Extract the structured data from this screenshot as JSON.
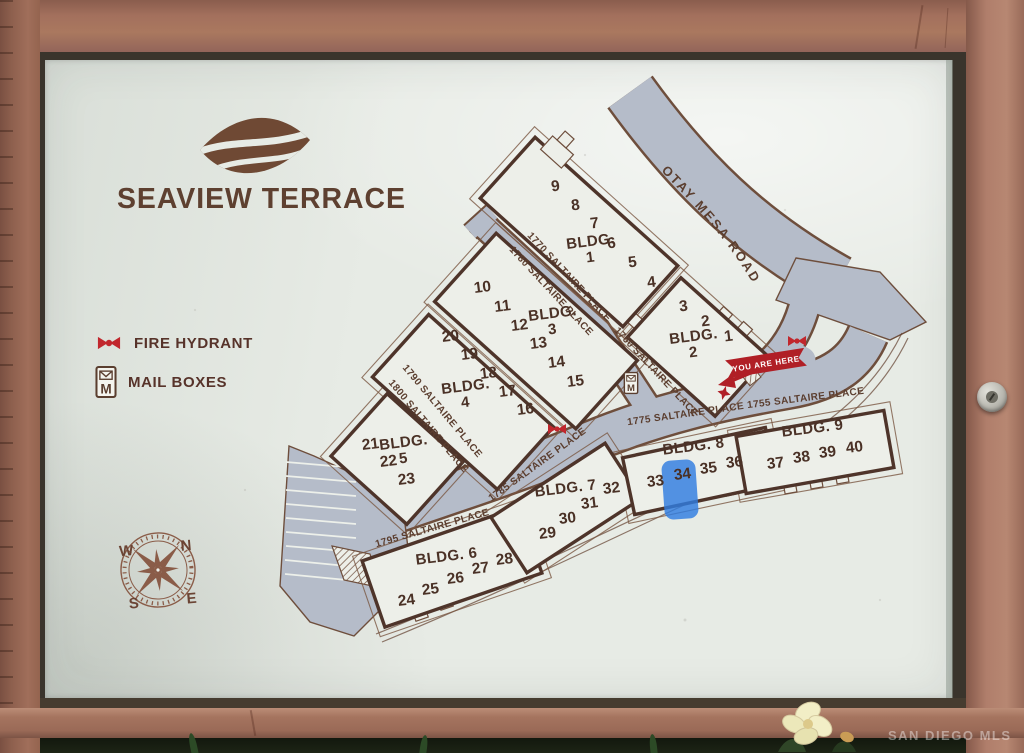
{
  "photo": {
    "watermark": "SAN DIEGO MLS"
  },
  "sign": {
    "title": "SEAVIEW TERRACE",
    "legend": {
      "fire_hydrant": "FIRE HYDRANT",
      "mail_boxes": "MAIL BOXES"
    },
    "compass": {
      "west": "W",
      "north": "N",
      "south": "S",
      "east": "E"
    }
  },
  "map": {
    "streets": {
      "otay": "OTAY MESA ROAD",
      "sp1770": "1770 SALTAIRE PLACE",
      "sp1780": "1780 SALTAIRE PLACE",
      "sp1760": "1760 SALTAIRE PLACE",
      "sp1790": "1790 SALTAIRE PLACE",
      "sp1800": "1800 SALTAIRE PLACE",
      "sp1775": "1775 SALTAIRE PLACE",
      "sp1755": "1755 SALTAIRE PLACE",
      "sp1785": "1785 SALTAIRE PLACE",
      "sp1795": "1795 SALTAIRE PLACE"
    },
    "you_are_here": "YOU ARE HERE",
    "highlight": {
      "unit": "34",
      "color": "#2f7ce0",
      "rect": [
        663,
        460,
        34,
        59,
        9,
        -4
      ]
    },
    "buildings": [
      {
        "name": "bldg-1",
        "label": "BLDG.",
        "num": "1",
        "stacked": true,
        "lx": 591,
        "ly": 246,
        "rect": [
          579,
          232,
          192,
          82,
          42
        ],
        "units": [
          [
            "9",
            556,
            191
          ],
          [
            "8",
            576,
            210
          ],
          [
            "7",
            595,
            228
          ],
          [
            "6",
            612,
            248
          ],
          [
            "5",
            633,
            267
          ],
          [
            "4",
            652,
            287
          ]
        ],
        "porches": [
          [
            589,
            226,
            13
          ],
          [
            607,
            247,
            13
          ],
          [
            625,
            269,
            13
          ],
          [
            643,
            291,
            13
          ],
          [
            634,
            320,
            12
          ],
          [
            654,
            334,
            12
          ]
        ]
      },
      {
        "name": "bldg-2",
        "label": "BLDG.",
        "num": "2",
        "stacked": true,
        "lx": 694,
        "ly": 341,
        "rect": [
          698,
          347,
          118,
          80,
          42
        ],
        "units": [
          [
            "3",
            684,
            311
          ],
          [
            "2",
            706,
            326
          ],
          [
            "1",
            729,
            341
          ]
        ],
        "porches": [
          [
            724,
            315,
            12
          ],
          [
            744,
            330,
            12
          ]
        ]
      },
      {
        "name": "bldg-3",
        "label": "BLDG.",
        "num": "3",
        "stacked": true,
        "lx": 553,
        "ly": 318,
        "rect": [
          536,
          331,
          190,
          92,
          42
        ],
        "units": [
          [
            "10",
            483,
            292
          ],
          [
            "11",
            503,
            311
          ],
          [
            "12",
            520,
            330
          ],
          [
            "13",
            539,
            348
          ],
          [
            "14",
            557,
            367
          ],
          [
            "15",
            576,
            386
          ]
        ],
        "porches": [
          [
            470,
            308,
            15
          ],
          [
            490,
            330,
            15
          ],
          [
            512,
            352,
            15
          ],
          [
            532,
            373,
            15
          ]
        ]
      },
      {
        "name": "bldg-4",
        "label": "BLDG.",
        "num": "4",
        "stacked": true,
        "lx": 466,
        "ly": 391,
        "rect": [
          463,
          402,
          168,
          84,
          42
        ],
        "units": [
          [
            "20",
            451,
            341
          ],
          [
            "19",
            470,
            359
          ],
          [
            "18",
            489,
            378
          ],
          [
            "17",
            508,
            396
          ],
          [
            "16",
            526,
            414
          ]
        ],
        "porches": []
      },
      {
        "name": "bldg-5",
        "label": "BLDG.",
        "num": "5",
        "stacked": true,
        "lx": 404,
        "ly": 447,
        "rect": [
          397,
          459,
          102,
          84,
          42
        ],
        "units": [
          [
            "21",
            371,
            449
          ],
          [
            "22",
            389,
            466
          ],
          [
            "23",
            407,
            484
          ]
        ],
        "porches": []
      },
      {
        "name": "bldg-6",
        "label": "BLDG. 6",
        "stacked": false,
        "lx": 447,
        "ly": 561,
        "rect": [
          452,
          567,
          166,
          70,
          -19
        ],
        "units": [
          [
            "24",
            407,
            605
          ],
          [
            "25",
            431,
            594
          ],
          [
            "26",
            456,
            583
          ],
          [
            "27",
            481,
            573
          ],
          [
            "28",
            505,
            564
          ]
        ],
        "porches": [
          [
            420,
            613,
            13
          ],
          [
            445,
            602,
            13
          ],
          [
            470,
            590,
            13
          ],
          [
            495,
            580,
            13
          ]
        ]
      },
      {
        "name": "bldg-7",
        "label": "BLDG. 7",
        "stacked": false,
        "lx": 566,
        "ly": 493,
        "rect": [
          566,
          508,
          136,
          66,
          -33
        ],
        "units": [
          [
            "29",
            548,
            538
          ],
          [
            "30",
            568,
            523
          ],
          [
            "31",
            590,
            508
          ],
          [
            "32",
            612,
            493
          ]
        ],
        "porches": [
          [
            538,
            552,
            12
          ],
          [
            560,
            538,
            12
          ],
          [
            583,
            525,
            12
          ]
        ]
      },
      {
        "name": "bldg-8",
        "label": "BLDG. 8",
        "stacked": false,
        "lx": 694,
        "ly": 451,
        "rect": [
          700,
          471,
          146,
          58,
          -12
        ],
        "units": [
          [
            "33",
            656,
            486
          ],
          [
            "34",
            683,
            479
          ],
          [
            "35",
            709,
            473
          ],
          [
            "36",
            735,
            467
          ]
        ],
        "porches": [
          [
            674,
            500,
            12
          ],
          [
            703,
            494,
            12
          ],
          [
            731,
            489,
            12
          ]
        ]
      },
      {
        "name": "bldg-9",
        "label": "BLDG. 9",
        "stacked": false,
        "lx": 813,
        "ly": 433,
        "rect": [
          815,
          452,
          150,
          58,
          -10
        ],
        "units": [
          [
            "37",
            776,
            468
          ],
          [
            "38",
            802,
            462
          ],
          [
            "39",
            828,
            457
          ],
          [
            "40",
            855,
            452
          ]
        ],
        "porches": [
          [
            790,
            487,
            12
          ],
          [
            816,
            482,
            12
          ],
          [
            842,
            477,
            12
          ]
        ]
      }
    ],
    "markers": {
      "fire_hydrants": [
        [
          557,
          429
        ],
        [
          797,
          341
        ]
      ],
      "mailboxes": [
        [
          631,
          383
        ]
      ]
    }
  }
}
